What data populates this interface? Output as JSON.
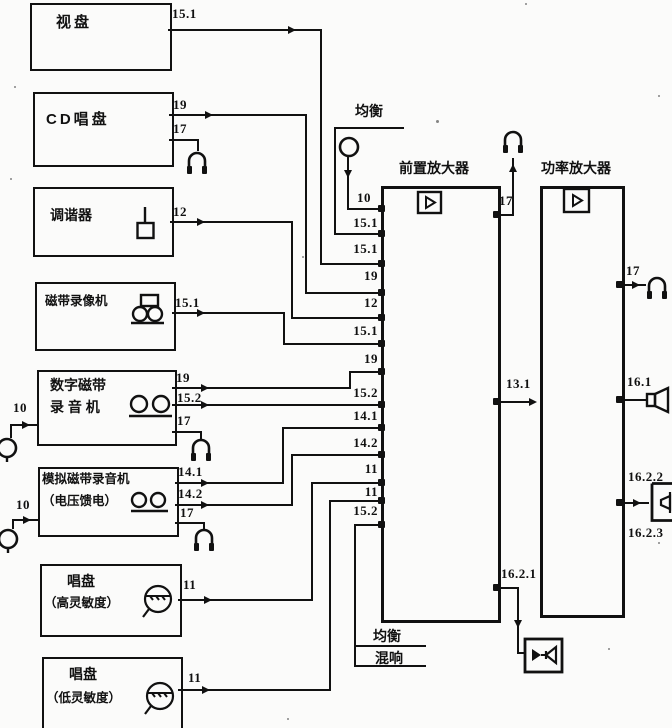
{
  "diagram": {
    "devices": {
      "video_disc": {
        "name": "视盘",
        "out": "15.1"
      },
      "cd_player": {
        "name": "CD唱盘",
        "out_line": "19",
        "out_phones": "17"
      },
      "tuner": {
        "name": "调谐器",
        "out": "12"
      },
      "vcr": {
        "name": "磁带录像机",
        "out": "15.1"
      },
      "dat": {
        "name_line1": "数字磁带",
        "name_line2": "录 音 机",
        "out_line": "19",
        "out_rec": "15.2",
        "out_phones": "17",
        "in_mic": "10"
      },
      "analog_tape": {
        "name_line1": "模拟磁带录音机",
        "name_line2": "（电压馈电）",
        "out_1": "14.1",
        "out_2": "14.2",
        "out_phones": "17",
        "in_mic": "10"
      },
      "turntable_high": {
        "name_line1": "唱盘",
        "name_line2": "（高灵敏度）",
        "out": "11"
      },
      "turntable_low": {
        "name_line1": "唱盘",
        "name_line2": "（低灵敏度）",
        "out": "11"
      }
    },
    "equalizer_top": {
      "name": "均衡",
      "mic_in": "10"
    },
    "preamp": {
      "title": "前置放大器",
      "inputs": [
        "10",
        "15.1",
        "15.1",
        "19",
        "12",
        "15.1",
        "19",
        "15.2",
        "14.1",
        "14.2",
        "11",
        "11",
        "15.2"
      ],
      "out_phones": "17",
      "out_main": "13.1",
      "out_sub": "16.2.1"
    },
    "loop": {
      "equalizer": "均衡",
      "reverb": "混响"
    },
    "poweramp": {
      "title": "功率放大器",
      "out_phones": "17",
      "out_speaker": "16.1",
      "out_speaker2_top": "16.2.2",
      "out_speaker2_bottom": "16.2.3"
    }
  }
}
